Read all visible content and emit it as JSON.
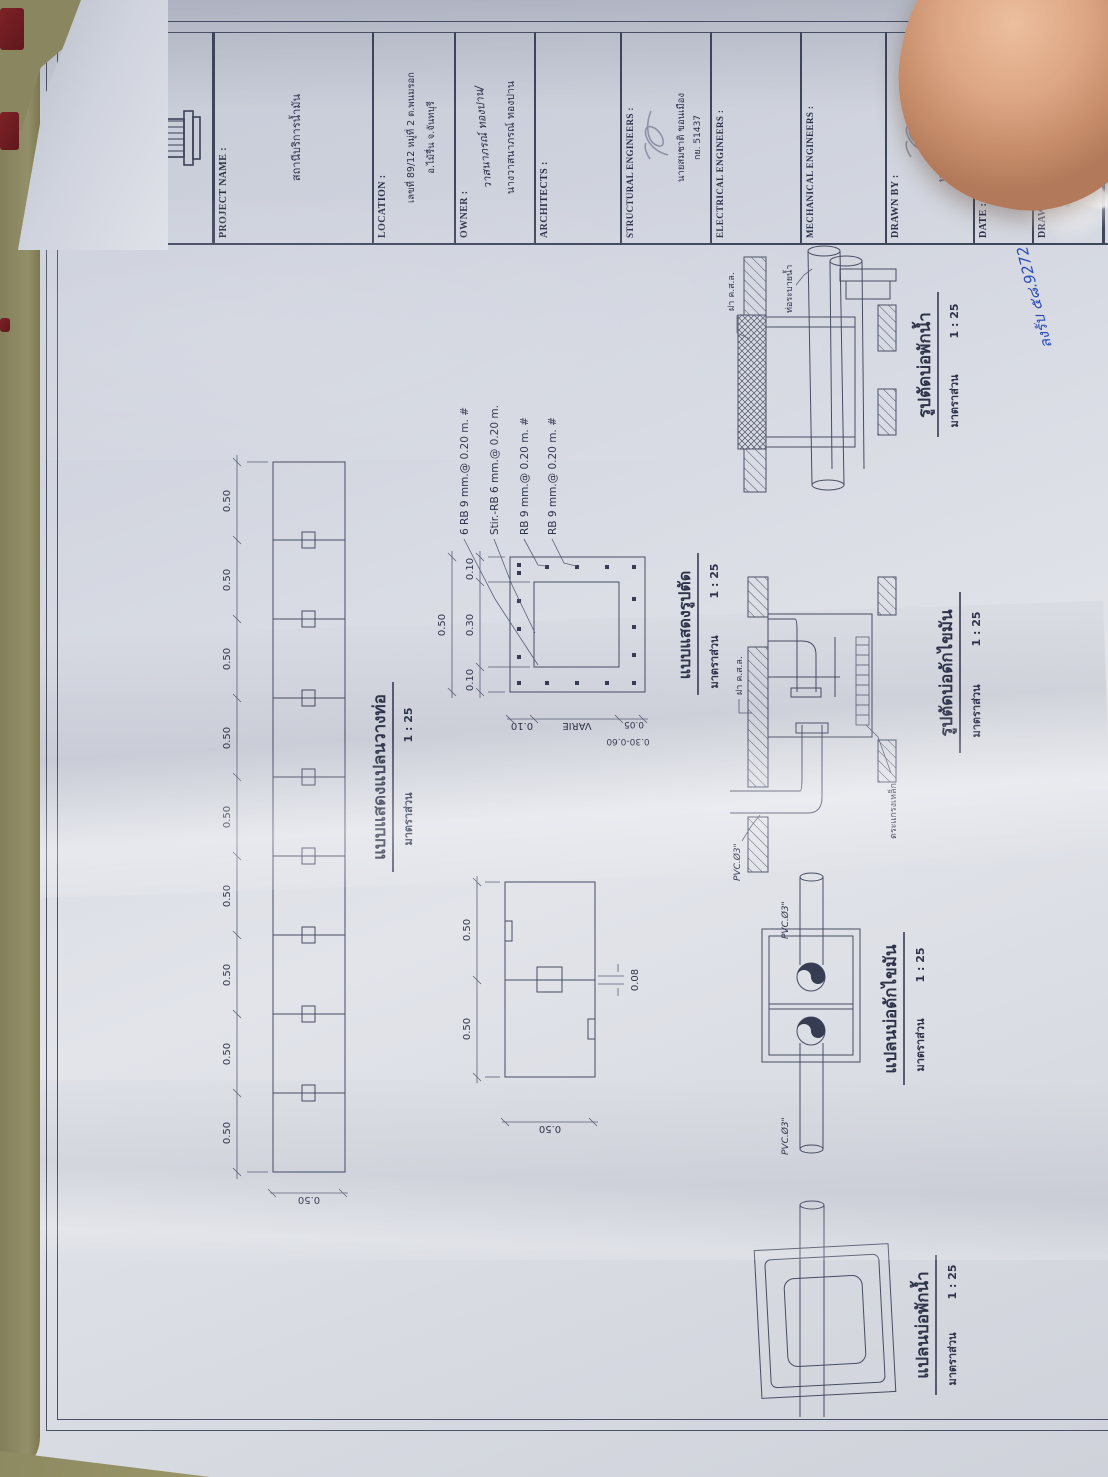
{
  "titleblock": {
    "project": {
      "label": "PROJECT NAME :",
      "value": "สถานีบริการน้ำมัน"
    },
    "location": {
      "label": "LOCATION :",
      "line1": "เลขที่ 89/12 หมู่ที่ 2 ต.พนมรอก",
      "line2": "อ.ไม้รื่น จ.จันทบุรี"
    },
    "owner": {
      "label": "OWNER :",
      "value": "นางวาสนาภรณ์ ทองปาน",
      "handwritten": "วาสนาภรณ์ ทองปาน/"
    },
    "architects": {
      "label": "ARCHITECTS :"
    },
    "structural": {
      "label": "STRUCTURAL ENGINEERS :",
      "name": "นายสมชาติ ขอนเมือง",
      "license": "กย. 51437"
    },
    "electrical": {
      "label": "ELECTRICAL ENGINEERS :"
    },
    "mechanical": {
      "label": "MECHANICAL ENGINEERS :"
    },
    "drawn_by": {
      "label": "DRAWN BY :",
      "name": "นายสมชาติ ขอนเมือง",
      "license": "กย. 51437"
    },
    "date": {
      "label": "DATE :"
    },
    "drawing_title": {
      "label": "DRAWINGN TITLE :",
      "line1": "แบบแสดงรูปตัด, รูปด้านรายละเอียด",
      "line2": "แปลนบ่อพัก และรายละเอียด"
    },
    "drawing_no": {
      "label": "DRAWINGN NO :",
      "value": "16 / 27"
    },
    "scale": {
      "label": "SCALE :"
    }
  },
  "scale_note": {
    "label": "มาตราส่วน",
    "value": "1 : 25"
  },
  "dims": {
    "d050": "0.50",
    "d010": "0.10",
    "d030": "0.30",
    "d008": "0.08",
    "d005": "0.05",
    "varie": "VARIE",
    "d3060": "0.30-0.60"
  },
  "figures": {
    "pipe_plan_title": "แบบแสดงแปลนวางท่อ",
    "section_title": "แบบแสดงรูปตัด",
    "grease_plan_title": "แปลนบ่อดักไขมัน",
    "grease_section_title": "รูปตัดบ่อดักไขมัน",
    "sump_plan_title": "แปลนบ่อพักน้ำ",
    "sump_section_title": "รูปตัดบ่อพักน้ำ"
  },
  "rebar_labels": [
    "6 RB 9 mm.@ 0.20 m. #",
    "Stir.-RB 6 mm.@ 0.20 m.",
    "RB 9 mm.@ 0.20 m. #",
    "RB 9 mm.@ 0.20 m. #"
  ],
  "pipe_labels": {
    "pvc": "PVC.Ø3\"",
    "lid": "ฝา ค.ส.ล.",
    "grating": "ตระแกรงเหล็ก",
    "drain": "ท่อระบายน้ำ"
  },
  "handwriting": {
    "note": "ลงรับ ๕๘.9272"
  }
}
